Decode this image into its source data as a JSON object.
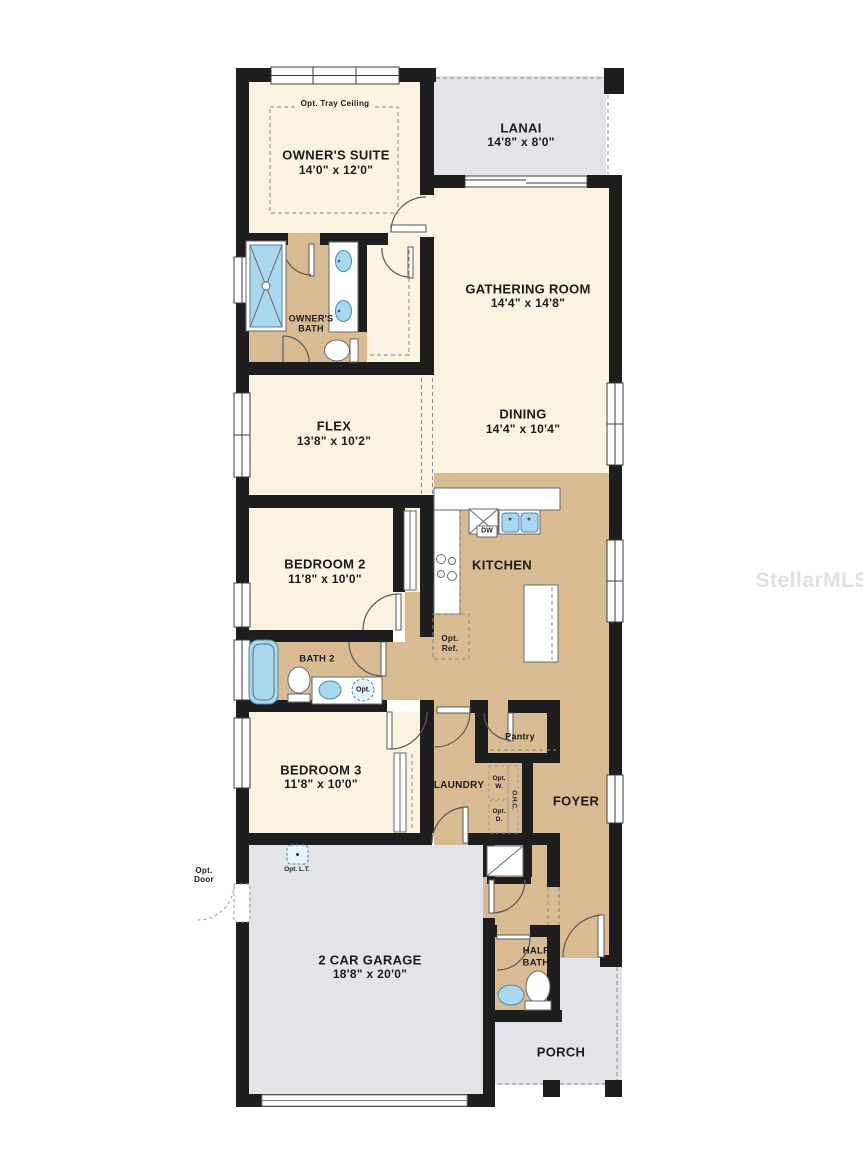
{
  "watermark": "StellarMLS",
  "colors": {
    "wall": "#1e1e1e",
    "cream": "#faf3e2",
    "tan": "#d8bb92",
    "gray": "#e2e4e7",
    "blue": "#a9d7ef",
    "blue_stroke": "#4e87a8",
    "label": "#1b1b1b",
    "watermark": "#d9d9d9"
  },
  "rooms": {
    "owners_suite": {
      "name": "OWNER'S SUITE",
      "dims": "14'0\" x 12'0\""
    },
    "lanai": {
      "name": "LANAI",
      "dims": "14'8\" x 8'0\""
    },
    "gathering": {
      "name": "GATHERING ROOM",
      "dims": "14'4\" x 14'8\""
    },
    "owners_bath": {
      "line1": "OWNER'S",
      "line2": "BATH"
    },
    "flex": {
      "name": "FLEX",
      "dims": "13'8\" x 10'2\""
    },
    "dining": {
      "name": "DINING",
      "dims": "14'4\" x 10'4\""
    },
    "kitchen": {
      "name": "KITCHEN"
    },
    "bedroom2": {
      "name": "BEDROOM 2",
      "dims": "11'8\" x 10'0\""
    },
    "bath2": {
      "name": "BATH 2"
    },
    "bedroom3": {
      "name": "BEDROOM 3",
      "dims": "11'8\" x 10'0\""
    },
    "laundry": {
      "name": "LAUNDRY"
    },
    "pantry": {
      "name": "Pantry"
    },
    "foyer": {
      "name": "FOYER"
    },
    "garage": {
      "name": "2 CAR GARAGE",
      "dims": "18'8\" x 20'0\""
    },
    "half_bath": {
      "line1": "HALF",
      "line2": "BATH"
    },
    "porch": {
      "name": "PORCH"
    }
  },
  "annotations": {
    "tray": "Opt. Tray Ceiling",
    "dw": "DW",
    "opt_ref1": "Opt.",
    "opt_ref2": "Ref.",
    "opt_sink": "Opt.",
    "opt_w1": "Opt.",
    "opt_w2": "W.",
    "opt_d1": "Opt.",
    "opt_d2": "D.",
    "ohc": "O.H.C.",
    "opt_door1": "Opt.",
    "opt_door2": "Door",
    "opt_lt": "Opt. L.T."
  }
}
